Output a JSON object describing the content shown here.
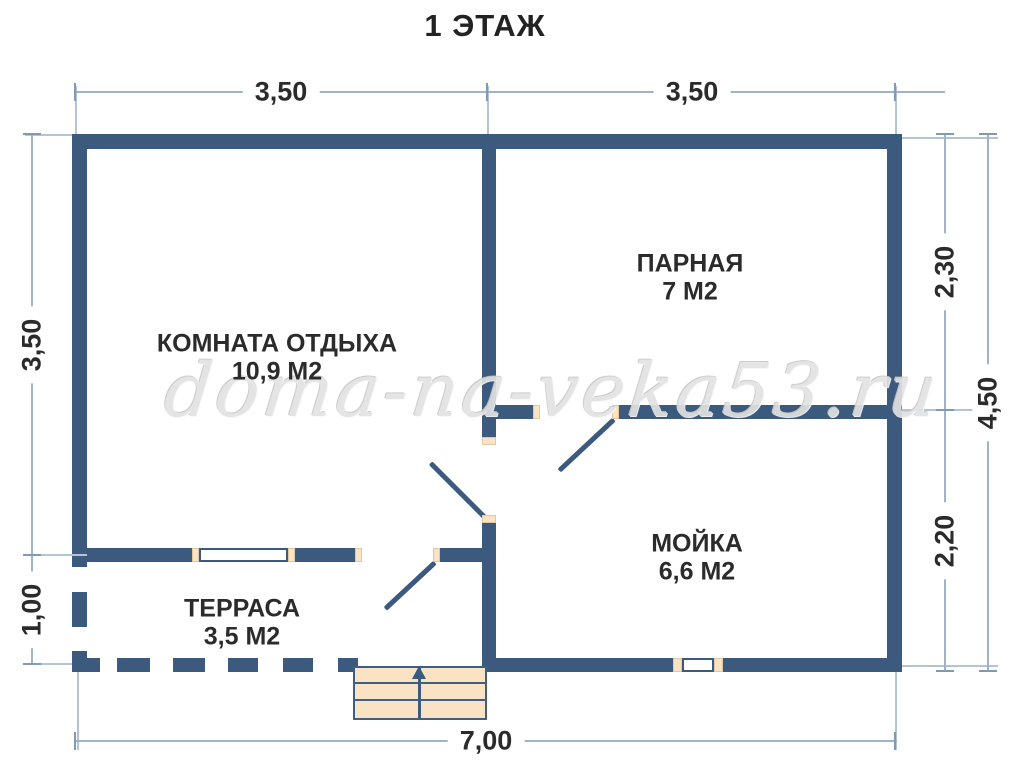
{
  "title": "1 ЭТАЖ",
  "watermark": "doma-na-veka53.ru",
  "rooms": [
    {
      "name": "КОМНАТА ОТДЫХА",
      "area": "10,9 М2"
    },
    {
      "name": "ПАРНАЯ",
      "area": "7 М2"
    },
    {
      "name": "МОЙКА",
      "area": "6,6 М2"
    },
    {
      "name": "ТЕРРАСА",
      "area": "3,5 М2"
    }
  ],
  "dimensions": {
    "top": [
      "3,50",
      "3,50"
    ],
    "left": [
      "3,50",
      "1,00"
    ],
    "right_inner": [
      "2,30",
      "2,20"
    ],
    "right_outer": "4,50",
    "bottom": "7,00"
  },
  "icons": {
    "stairs_direction": "up-arrow"
  },
  "colors": {
    "wall": "#3b5a7d",
    "dimension_line": "#9fb4c7",
    "door_jamb": "#f9e3c3",
    "stairs_fill": "#fae3c4",
    "label_text": "#2b2b2b",
    "watermark": "#e2e2e2"
  }
}
